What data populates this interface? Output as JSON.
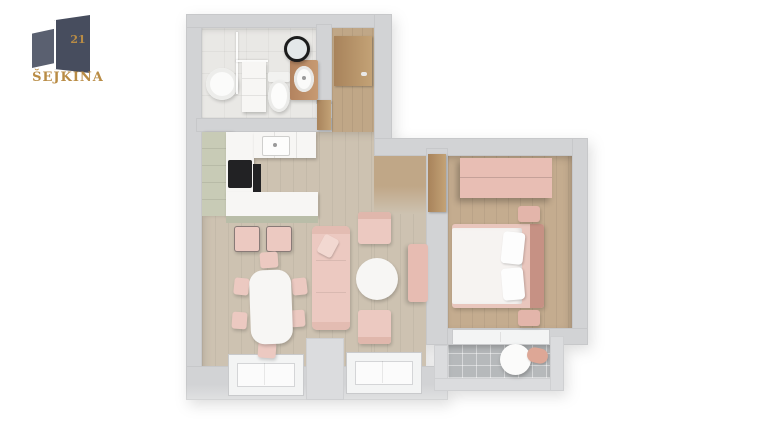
{
  "brand": {
    "name": "ŠEJKINA",
    "number": "21",
    "text_color": "#b98c45",
    "building_color_left": "#5a6070",
    "building_color_right": "#474d5e"
  },
  "palette": {
    "background": "#ffffff",
    "wall": "#d2d3d5",
    "wall_light": "#dbdcde",
    "floor_bathroom": "#e9e8e5",
    "floor_living_wood": "#cdc2b1",
    "floor_hall_wood": "#c0a787",
    "floor_bedroom_wood": "#c4ac8f",
    "floor_balcony_tile": "#b6b9bb",
    "furniture_pink": "#ecc9c1",
    "headboard_pink_dark": "#c69184",
    "kitchen_cabinet_sage": "#c8cbb6",
    "counter_white": "#f7f6f4",
    "appliance_black": "#222224",
    "door_wood": "#b3895f",
    "mirror_frame_black": "#1c1c1c"
  },
  "floorplan": {
    "type": "3d-top-down-apartment-render",
    "rooms": [
      {
        "name": "bathroom",
        "floor_color": "#e9e8e5"
      },
      {
        "name": "entry-hall",
        "floor_color": "#c0a787"
      },
      {
        "name": "kitchen-living-dining",
        "floor_color": "#cdc2b1"
      },
      {
        "name": "bedroom",
        "floor_color": "#c4ac8f"
      },
      {
        "name": "balcony",
        "floor_color": "#b6b9bb"
      }
    ],
    "furniture": {
      "bathroom": [
        "washing-machine",
        "shower-glass-partition",
        "storage-cabinet",
        "toilet",
        "wood-vanity-sink",
        "round-black-mirror"
      ],
      "kitchen": [
        "l-shaped-counter",
        "sage-cabinets",
        "cooktop",
        "oven",
        "kitchen-sink",
        "bar-stool",
        "bar-stool"
      ],
      "dining": [
        "white-dining-table",
        "chair",
        "chair",
        "chair",
        "chair",
        "chair",
        "chair"
      ],
      "living": [
        "pink-sofa",
        "sofa-pillow",
        "round-coffee-table",
        "armchair",
        "armchair",
        "tv-sideboard"
      ],
      "bedroom": [
        "pink-wardrobe",
        "double-bed",
        "duvet",
        "pillow",
        "pillow",
        "headboard",
        "nightstand",
        "nightstand"
      ],
      "balcony": [
        "round-table",
        "lounge-chair"
      ],
      "doors": [
        "entry-door",
        "bathroom-door",
        "bedroom-door"
      ],
      "windows": [
        "living-window-left",
        "living-window-right",
        "bedroom-window"
      ]
    }
  }
}
